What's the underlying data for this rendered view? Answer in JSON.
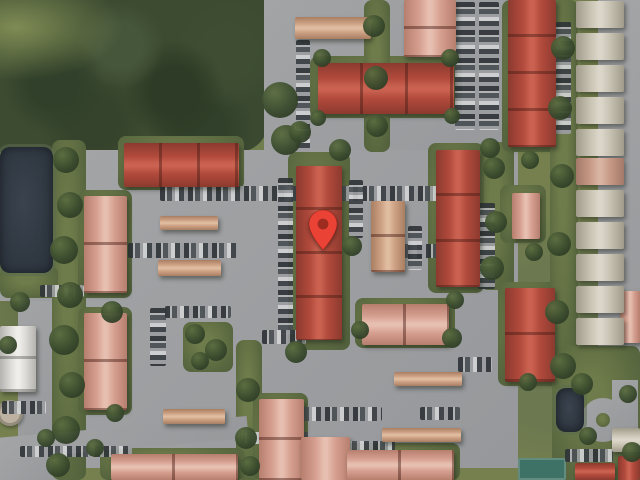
{
  "meta": {
    "view": "satellite",
    "description": "Aerial satellite map of a residential condo complex with red tiled roofs, parking lots, tree cover, a pond, and a dropped location pin",
    "width": 640,
    "height": 480
  },
  "marker": {
    "label": "dropped-pin",
    "tip_x": 323,
    "tip_y": 250,
    "color": "#EA4335",
    "dot_color": "#9E2B20"
  },
  "palette": {
    "grass": "#75804e",
    "forest": "#3d4b31",
    "pond": "#333b45",
    "pavement": "#9b9da0",
    "roofs": {
      "red": {
        "base": "#b14a3c",
        "light": "#cb6251",
        "dark": "#8c3a2f"
      },
      "salmon": {
        "base": "#d6a091",
        "light": "#e7bfb0",
        "dark": "#b67e6d"
      },
      "tan": {
        "base": "#cda184",
        "light": "#e0bda0",
        "dark": "#a87e62"
      },
      "white": {
        "base": "#dddcd8",
        "light": "#efeeea",
        "dark": "#b4b3ae"
      },
      "house": {
        "base": "#c9c3b4",
        "light": "#dbd6c9",
        "dark": "#a19b8b"
      },
      "housered": {
        "base": "#c79a87",
        "light": "#d9b4a3",
        "dark": "#a5796a"
      }
    },
    "car_colors": [
      "#2f3438",
      "#b3b5b7",
      "#4a4f54",
      "#9b9da0",
      "#d0d2d3",
      "#3a3f44"
    ]
  },
  "features": {
    "pavement_zones": [
      {
        "x": 264,
        "y": 0,
        "w": 254,
        "h": 158
      },
      {
        "x": 58,
        "y": 150,
        "w": 460,
        "h": 318
      },
      {
        "x": 620,
        "y": 0,
        "w": 20,
        "h": 395
      },
      {
        "x": 598,
        "y": 0,
        "w": 28,
        "h": 386
      },
      {
        "x": 18,
        "y": 285,
        "w": 64,
        "h": 152
      },
      {
        "x": 0,
        "y": 281,
        "w": 86,
        "h": 20
      },
      {
        "x": 0,
        "y": 445,
        "w": 60,
        "h": 35
      }
    ],
    "green_patches": [
      {
        "x": 52,
        "y": 140,
        "w": 34,
        "h": 340
      },
      {
        "x": 310,
        "y": 56,
        "w": 152,
        "h": 62
      },
      {
        "x": 364,
        "y": 0,
        "w": 26,
        "h": 152
      },
      {
        "x": 288,
        "y": 152,
        "w": 62,
        "h": 198
      },
      {
        "x": 480,
        "y": 142,
        "w": 34,
        "h": 148
      },
      {
        "x": 118,
        "y": 136,
        "w": 126,
        "h": 54
      },
      {
        "x": 78,
        "y": 190,
        "w": 54,
        "h": 108
      },
      {
        "x": 78,
        "y": 307,
        "w": 54,
        "h": 108
      },
      {
        "x": 500,
        "y": 185,
        "w": 46,
        "h": 58
      },
      {
        "x": 498,
        "y": 282,
        "w": 60,
        "h": 104
      },
      {
        "x": 355,
        "y": 298,
        "w": 100,
        "h": 50
      },
      {
        "x": 428,
        "y": 143,
        "w": 56,
        "h": 150
      },
      {
        "x": 502,
        "y": 0,
        "w": 58,
        "h": 152
      },
      {
        "x": 183,
        "y": 322,
        "w": 50,
        "h": 50
      },
      {
        "x": 236,
        "y": 340,
        "w": 26,
        "h": 140
      },
      {
        "x": 550,
        "y": 0,
        "w": 28,
        "h": 390
      },
      {
        "x": 100,
        "y": 448,
        "w": 145,
        "h": 32
      },
      {
        "x": 253,
        "y": 393,
        "w": 55,
        "h": 87
      },
      {
        "x": 340,
        "y": 443,
        "w": 120,
        "h": 37
      },
      {
        "x": 0,
        "y": 266,
        "w": 58,
        "h": 32
      },
      {
        "x": 552,
        "y": 346,
        "w": 88,
        "h": 134
      }
    ],
    "roads": [
      {
        "t": "rect",
        "x": -4,
        "y": 427,
        "w": 252,
        "h": 22,
        "rot": -5
      },
      {
        "t": "rect",
        "x": 612,
        "y": 380,
        "w": 26,
        "h": 48,
        "rot": 0
      },
      {
        "t": "circle",
        "x": 581,
        "y": 398,
        "w": 44,
        "h": 44
      },
      {
        "t": "island",
        "x": 596,
        "y": 413,
        "w": 14,
        "h": 14
      }
    ],
    "ponds": [
      {
        "x": 0,
        "y": 147,
        "w": 53,
        "h": 126
      },
      {
        "x": 556,
        "y": 388,
        "w": 28,
        "h": 44
      }
    ],
    "tennis_court": {
      "x": 518,
      "y": 458,
      "w": 48,
      "h": 22
    },
    "round_structure": {
      "x": -3,
      "y": 400,
      "w": 26,
      "h": 26
    },
    "car_rows": [
      {
        "x": 296,
        "y": 40,
        "w": 14,
        "h": 112,
        "o": "v"
      },
      {
        "x": 455,
        "y": 2,
        "w": 20,
        "h": 128,
        "o": "v"
      },
      {
        "x": 479,
        "y": 2,
        "w": 20,
        "h": 128,
        "o": "v"
      },
      {
        "x": 556,
        "y": 22,
        "w": 15,
        "h": 112,
        "o": "v"
      },
      {
        "x": 160,
        "y": 186,
        "w": 138,
        "h": 15,
        "o": "h"
      },
      {
        "x": 306,
        "y": 186,
        "w": 148,
        "h": 15,
        "o": "h"
      },
      {
        "x": 128,
        "y": 243,
        "w": 110,
        "h": 15,
        "o": "h"
      },
      {
        "x": 398,
        "y": 244,
        "w": 40,
        "h": 14,
        "o": "h"
      },
      {
        "x": 278,
        "y": 178,
        "w": 15,
        "h": 156,
        "o": "v"
      },
      {
        "x": 349,
        "y": 180,
        "w": 14,
        "h": 58,
        "o": "v"
      },
      {
        "x": 408,
        "y": 226,
        "w": 14,
        "h": 44,
        "o": "v"
      },
      {
        "x": 478,
        "y": 203,
        "w": 17,
        "h": 86,
        "o": "v"
      },
      {
        "x": 150,
        "y": 308,
        "w": 16,
        "h": 58,
        "o": "v"
      },
      {
        "x": 165,
        "y": 306,
        "w": 66,
        "h": 12,
        "o": "h"
      },
      {
        "x": 262,
        "y": 330,
        "w": 44,
        "h": 14,
        "o": "h"
      },
      {
        "x": 297,
        "y": 407,
        "w": 85,
        "h": 14,
        "o": "h"
      },
      {
        "x": 420,
        "y": 407,
        "w": 40,
        "h": 13,
        "o": "h"
      },
      {
        "x": 458,
        "y": 357,
        "w": 34,
        "h": 15,
        "o": "h"
      },
      {
        "x": 2,
        "y": 401,
        "w": 44,
        "h": 13,
        "o": "h"
      },
      {
        "x": 20,
        "y": 446,
        "w": 112,
        "h": 11,
        "o": "h"
      },
      {
        "x": 345,
        "y": 441,
        "w": 50,
        "h": 12,
        "o": "h"
      },
      {
        "x": 565,
        "y": 449,
        "w": 48,
        "h": 13,
        "o": "h"
      },
      {
        "x": 240,
        "y": 432,
        "w": 70,
        "h": 12,
        "o": "h"
      },
      {
        "x": 40,
        "y": 285,
        "w": 44,
        "h": 12,
        "o": "h"
      }
    ],
    "buildings": [
      {
        "x": 295,
        "y": 17,
        "w": 76,
        "h": 22,
        "c": "tan",
        "d": "h",
        "s": 1
      },
      {
        "x": 404,
        "y": 0,
        "w": 52,
        "h": 57,
        "c": "salmon",
        "d": "v",
        "s": 2
      },
      {
        "x": 318,
        "y": 63,
        "w": 136,
        "h": 51,
        "c": "red",
        "d": "h",
        "s": 3
      },
      {
        "x": 508,
        "y": 0,
        "w": 48,
        "h": 147,
        "c": "red",
        "d": "v",
        "s": 4
      },
      {
        "x": 124,
        "y": 143,
        "w": 115,
        "h": 44,
        "c": "red",
        "d": "h",
        "s": 3
      },
      {
        "x": 84,
        "y": 196,
        "w": 43,
        "h": 97,
        "c": "salmon",
        "d": "v",
        "s": 2
      },
      {
        "x": 160,
        "y": 216,
        "w": 58,
        "h": 14,
        "c": "tan",
        "d": "h",
        "s": 1
      },
      {
        "x": 158,
        "y": 260,
        "w": 63,
        "h": 16,
        "c": "tan",
        "d": "h",
        "s": 1
      },
      {
        "x": 296,
        "y": 166,
        "w": 46,
        "h": 174,
        "c": "red",
        "d": "v",
        "s": 4
      },
      {
        "x": 371,
        "y": 201,
        "w": 34,
        "h": 71,
        "c": "tan",
        "d": "v",
        "s": 2
      },
      {
        "x": 436,
        "y": 150,
        "w": 44,
        "h": 137,
        "c": "red",
        "d": "v",
        "s": 3
      },
      {
        "x": 512,
        "y": 193,
        "w": 28,
        "h": 46,
        "c": "salmon",
        "d": "v",
        "s": 1
      },
      {
        "x": 505,
        "y": 288,
        "w": 50,
        "h": 94,
        "c": "red",
        "d": "v",
        "s": 2
      },
      {
        "x": 362,
        "y": 304,
        "w": 87,
        "h": 41,
        "c": "salmon",
        "d": "h",
        "s": 2
      },
      {
        "x": 84,
        "y": 313,
        "w": 43,
        "h": 97,
        "c": "salmon",
        "d": "v",
        "s": 2
      },
      {
        "x": 0,
        "y": 326,
        "w": 36,
        "h": 66,
        "c": "white",
        "d": "v",
        "s": 2
      },
      {
        "x": 163,
        "y": 409,
        "w": 62,
        "h": 15,
        "c": "tan",
        "d": "h",
        "s": 1
      },
      {
        "x": 394,
        "y": 372,
        "w": 68,
        "h": 14,
        "c": "tan",
        "d": "h",
        "s": 1
      },
      {
        "x": 382,
        "y": 428,
        "w": 79,
        "h": 14,
        "c": "tan",
        "d": "h",
        "s": 1
      },
      {
        "x": 259,
        "y": 399,
        "w": 45,
        "h": 81,
        "c": "salmon",
        "d": "v",
        "s": 2
      },
      {
        "x": 301,
        "y": 437,
        "w": 49,
        "h": 43,
        "c": "salmon",
        "d": "v",
        "s": 1
      },
      {
        "x": 347,
        "y": 450,
        "w": 107,
        "h": 30,
        "c": "salmon",
        "d": "h",
        "s": 2
      },
      {
        "x": 111,
        "y": 454,
        "w": 127,
        "h": 26,
        "c": "salmon",
        "d": "h",
        "s": 2
      },
      {
        "x": 575,
        "y": 463,
        "w": 40,
        "h": 17,
        "c": "red",
        "d": "h",
        "s": 1
      },
      {
        "x": 618,
        "y": 456,
        "w": 22,
        "h": 24,
        "c": "red",
        "d": "v",
        "s": 1
      },
      {
        "x": 620,
        "y": 291,
        "w": 20,
        "h": 52,
        "c": "salmon",
        "d": "v",
        "s": 1
      },
      {
        "x": 612,
        "y": 428,
        "w": 28,
        "h": 24,
        "c": "house",
        "d": "h",
        "s": 1
      }
    ],
    "houses": {
      "x": 576,
      "w": 48,
      "h": 27,
      "items": [
        {
          "y": 1
        },
        {
          "y": 33
        },
        {
          "y": 65
        },
        {
          "y": 97
        },
        {
          "y": 129
        },
        {
          "y": 158,
          "c": "housered"
        },
        {
          "y": 190
        },
        {
          "y": 222
        },
        {
          "y": 254
        },
        {
          "y": 286
        },
        {
          "y": 318
        }
      ]
    },
    "trees": [
      [
        280,
        100,
        18
      ],
      [
        286,
        140,
        15
      ],
      [
        66,
        160,
        13
      ],
      [
        70,
        205,
        13
      ],
      [
        64,
        250,
        14
      ],
      [
        70,
        295,
        13
      ],
      [
        64,
        340,
        15
      ],
      [
        72,
        385,
        13
      ],
      [
        66,
        430,
        14
      ],
      [
        58,
        465,
        12
      ],
      [
        300,
        132,
        11
      ],
      [
        340,
        150,
        11
      ],
      [
        352,
        246,
        10
      ],
      [
        296,
        352,
        11
      ],
      [
        374,
        26,
        11
      ],
      [
        376,
        78,
        12
      ],
      [
        377,
        126,
        11
      ],
      [
        494,
        168,
        11
      ],
      [
        496,
        222,
        11
      ],
      [
        492,
        268,
        12
      ],
      [
        490,
        148,
        10
      ],
      [
        563,
        48,
        12
      ],
      [
        560,
        108,
        12
      ],
      [
        562,
        176,
        12
      ],
      [
        559,
        244,
        12
      ],
      [
        557,
        312,
        12
      ],
      [
        563,
        366,
        13
      ],
      [
        195,
        334,
        10
      ],
      [
        216,
        350,
        11
      ],
      [
        200,
        361,
        9
      ],
      [
        248,
        390,
        12
      ],
      [
        246,
        438,
        11
      ],
      [
        250,
        466,
        10
      ],
      [
        360,
        330,
        9
      ],
      [
        452,
        338,
        10
      ],
      [
        455,
        300,
        9
      ],
      [
        112,
        312,
        11
      ],
      [
        115,
        413,
        9
      ],
      [
        95,
        448,
        9
      ],
      [
        582,
        384,
        11
      ],
      [
        588,
        436,
        9
      ],
      [
        632,
        452,
        10
      ],
      [
        628,
        394,
        9
      ],
      [
        20,
        302,
        10
      ],
      [
        8,
        345,
        9
      ],
      [
        46,
        438,
        9
      ],
      [
        322,
        58,
        9
      ],
      [
        450,
        58,
        9
      ],
      [
        318,
        118,
        8
      ],
      [
        452,
        116,
        8
      ],
      [
        530,
        160,
        9
      ],
      [
        534,
        252,
        9
      ],
      [
        528,
        382,
        9
      ]
    ]
  }
}
